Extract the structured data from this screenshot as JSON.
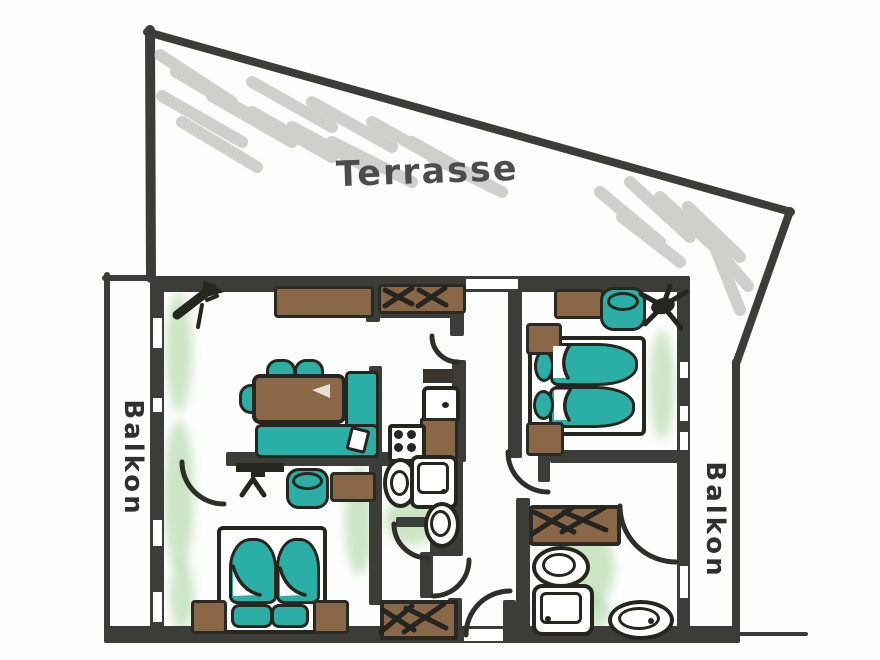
{
  "labels": {
    "terrace": "Terrasse",
    "balcony_left": "Balkon",
    "balcony_right": "Balkon"
  },
  "palette": {
    "wall": "#3c3c38",
    "ink_outline": "#26261f",
    "furniture_teal": "#2aaea6",
    "furniture_brown": "#8a6847",
    "floor_green_wash": "#86c478",
    "terrace_hatch_gray": "#a9a9a3",
    "paper": "#ffffff",
    "label_gray": "#4c4c4a"
  },
  "symbols": [
    "double-bed",
    "mattress",
    "pillow",
    "nightstand",
    "sofa",
    "sofa-cushion",
    "dining-table",
    "chair",
    "sideboard",
    "wardrobe-x-marks",
    "doormat-x-marks",
    "stove-burners",
    "kitchen-sink",
    "kitchen-counter",
    "washbasin",
    "washing-machine",
    "toilet",
    "bidet",
    "shower-tray",
    "bathroom-sink",
    "door-swing-arc",
    "window-slit",
    "plant",
    "wall-tv",
    "stool-drum",
    "coat-rack",
    "terrace-hatching"
  ]
}
